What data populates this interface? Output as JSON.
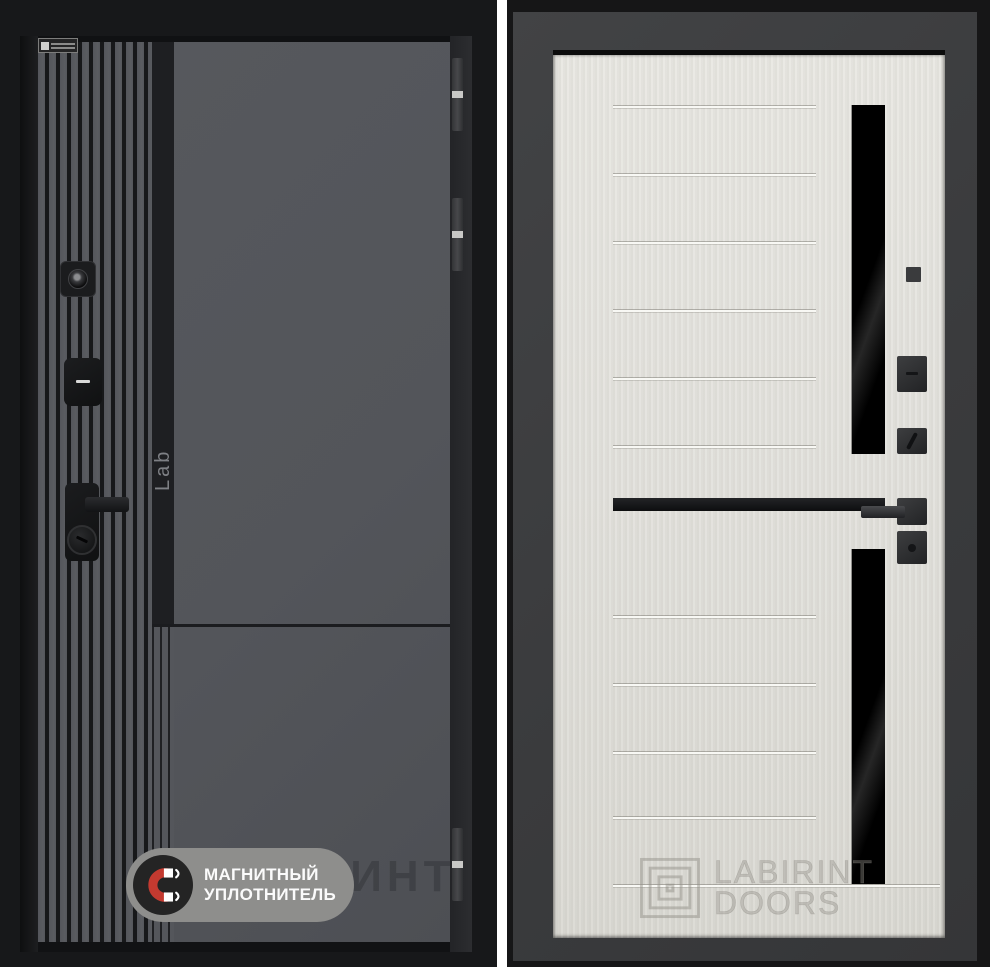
{
  "left_door": {
    "description_labels": {
      "side_logo": "Lab",
      "watermark_fragment": "ЛАБИРИНТ"
    },
    "seal_badge": {
      "line1": "МАГНИТНЫЙ",
      "line2": "УПЛОТНИТЕЛЬ",
      "icon": "magnet-icon",
      "magnet_color": "#c43a30",
      "pill_color": "#8e8e8c",
      "circle_color": "#242424"
    },
    "finish_color": "#54565a",
    "rib_dark_color": "#17181a"
  },
  "right_door": {
    "watermark": {
      "line1": "LABIRINT",
      "line2": "DOORS",
      "icon": "labyrinth-logo-icon"
    },
    "finish_color": "#e3e2dd",
    "glass_color": "#050505",
    "frame_color": "#3b3c3e"
  }
}
